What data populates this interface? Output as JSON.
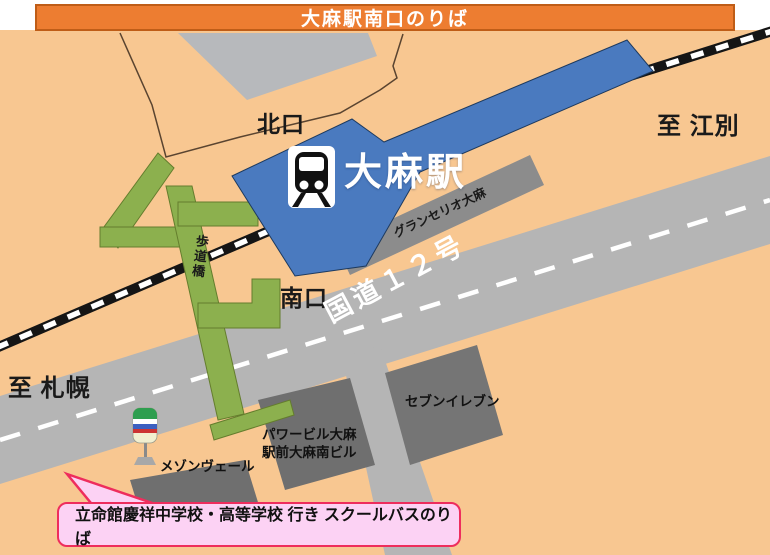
{
  "title": {
    "text": "大麻駅南口のりば"
  },
  "station": {
    "name": "大麻駅",
    "icon": "train-icon"
  },
  "exits": {
    "north": "北口",
    "south": "南口"
  },
  "directions": {
    "east": "至 江別",
    "west": "至 札幌"
  },
  "roads": {
    "route12": "国道１２号"
  },
  "bridge": {
    "label": "歩道橋"
  },
  "buildings": {
    "gran_serio": "グランセリオ大麻",
    "seven_eleven": "セブンイレブン",
    "power_line1": "パワービル大麻",
    "power_line2": "駅前大麻南ビル",
    "maison": "メゾンヴェール"
  },
  "bus_stop": {
    "icon": "bus-stop-sign-icon"
  },
  "callout": {
    "text": "立命館慶祥中学校・高等学校 行き スクールバスのりば"
  },
  "colors": {
    "map_background": "#f8c791",
    "title_orange": "#ed7d31",
    "station_blue": "#4a7abf",
    "road_gray": "#b5b5b5",
    "building_dark_gray": "#757575",
    "building_mid_gray": "#8c8c8c",
    "bridge_green": "#8cb04e",
    "callout_pink": "#fcd2f4",
    "callout_border_red": "#ee2d5d",
    "railway_black": "#151515"
  }
}
